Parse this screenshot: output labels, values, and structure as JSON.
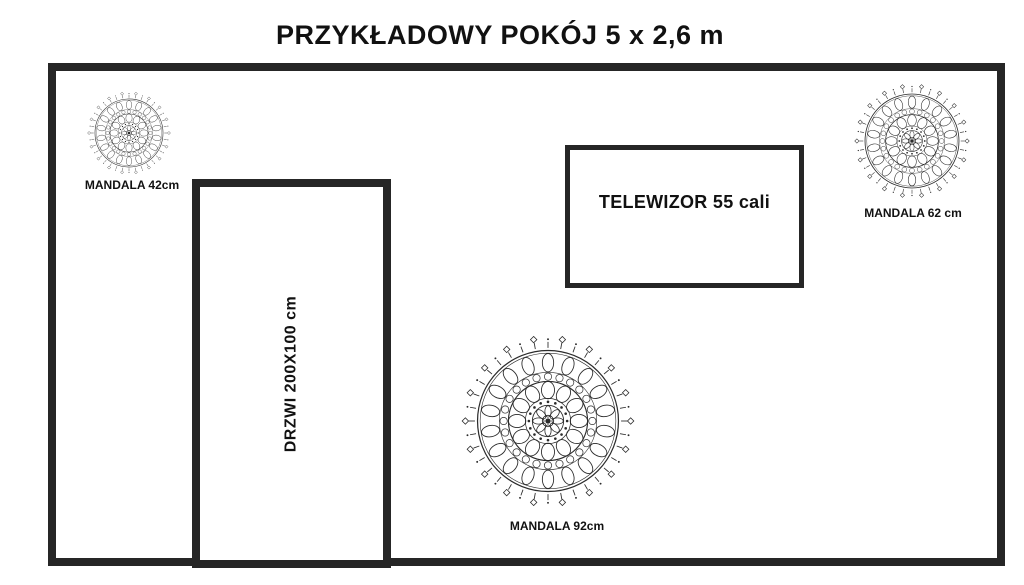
{
  "title": "PRZYKŁADOWY POKÓJ 5 x 2,6 m",
  "door": {
    "label": "DRZWI 200X100 cm"
  },
  "tv": {
    "label": "TELEWIZOR 55 cali"
  },
  "mandalas": [
    {
      "id": "small",
      "label": "MANDALA 42cm",
      "diameter_cm": 42
    },
    {
      "id": "medium",
      "label": "MANDALA 62 cm",
      "diameter_cm": 62
    },
    {
      "id": "large",
      "label": "MANDALA 92cm",
      "diameter_cm": 92
    }
  ],
  "colors": {
    "background": "#ffffff",
    "wall_line": "#262626",
    "text": "#111111",
    "mandala": "#2b2b2b"
  }
}
